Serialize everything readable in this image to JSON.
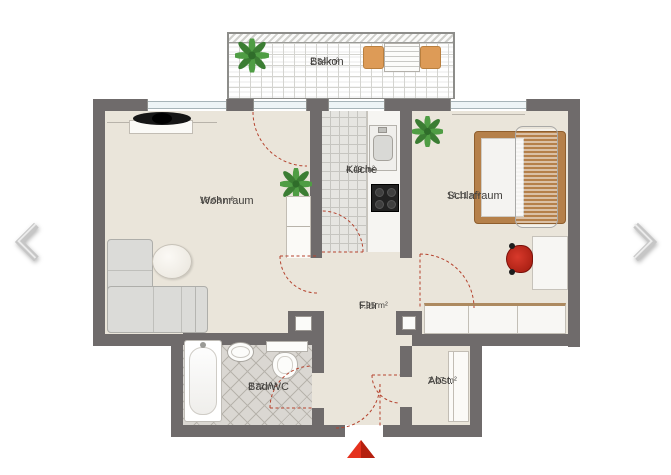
{
  "floorplan": {
    "rooms": [
      {
        "id": "balkon",
        "name": "Balkon",
        "area": "2,54 m²"
      },
      {
        "id": "wohnraum",
        "name": "Wohnraum",
        "area": "18,68 m²"
      },
      {
        "id": "kueche",
        "name": "Küche",
        "area": "4,49 m²"
      },
      {
        "id": "schlafraum",
        "name": "Schlafraum",
        "area": "14,11 m²"
      },
      {
        "id": "flur",
        "name": "Flur",
        "area": "5,95 m²"
      },
      {
        "id": "bad",
        "name": "Bad/WC",
        "area": "3,72 m²"
      },
      {
        "id": "abstellraum",
        "name": "Abst.",
        "area": "2,07 m²"
      }
    ],
    "colors": {
      "wall": "#6f6b6b",
      "floor": "#eae5da",
      "door_swing": "#b5432e",
      "entrance_red": "#e5311d",
      "bed_frame": "#b5804a",
      "chair_orange": "#dd9b57",
      "desk_chair_red": "#c6281c",
      "plant_green": "#4f9d44",
      "label_text": "#3e3c39"
    },
    "nav": {
      "prev": "previous-plan",
      "next": "next-plan"
    },
    "entrance_marker": "red-triangle-up"
  }
}
